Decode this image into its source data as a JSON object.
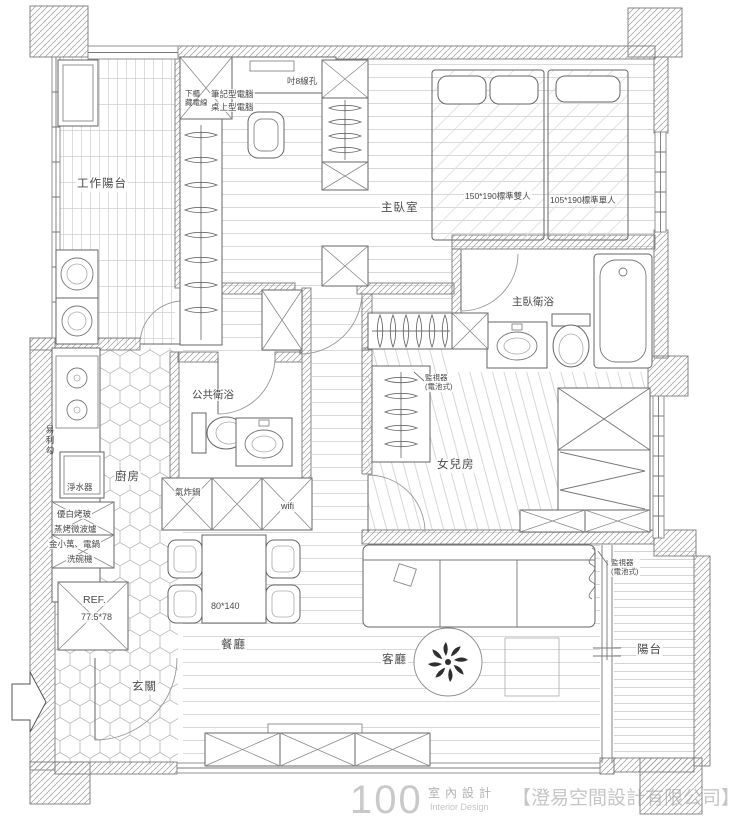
{
  "meta": {
    "width": 729,
    "height": 825,
    "type": "apartment-floor-plan"
  },
  "colors": {
    "wall_line": "#7a7a7a",
    "floor_line": "#c8c8c8",
    "text": "#4a4a4a",
    "watermark": "#c9c9c9"
  },
  "labels": {
    "work_balcony": "工作陽台",
    "cabinet_note": "下櫃\n藏電線",
    "laptop": "筆記型電腦",
    "desktop_pc": "桌上型電腦",
    "wire_hole": "吋8線孔",
    "master_bedroom": "主臥室",
    "double_bed": "150*190標準雙人",
    "single_bed": "105*190標準單人",
    "master_bath": "主臥衛浴",
    "public_bath": "公共衛浴",
    "kitchen": "廚房",
    "hook_rail": "易利勾",
    "water_purifier": "淨水器",
    "glass_panel": "優白烤玻",
    "steam_oven": "蒸烤微波爐",
    "rice_cooker": "金小萬、電鍋",
    "dishwasher": "洗碗機",
    "monitor_cam1": "監視器\n(電池式)",
    "daughter_room": "女兒房",
    "air_fryer": "氣炸鍋",
    "wifi": "wifi",
    "fridge": "REF.",
    "fridge_size": "77.5*78",
    "table_size": "80*140",
    "dining": "餐廳",
    "entry": "玄關",
    "living": "客廳",
    "monitor_cam2": "監視器\n(電池式)",
    "balcony": "陽台"
  },
  "watermark": {
    "logo": "100",
    "cn": "室內設計",
    "en": "Interior Design",
    "company": "【澄易空間設計有限公司】"
  }
}
